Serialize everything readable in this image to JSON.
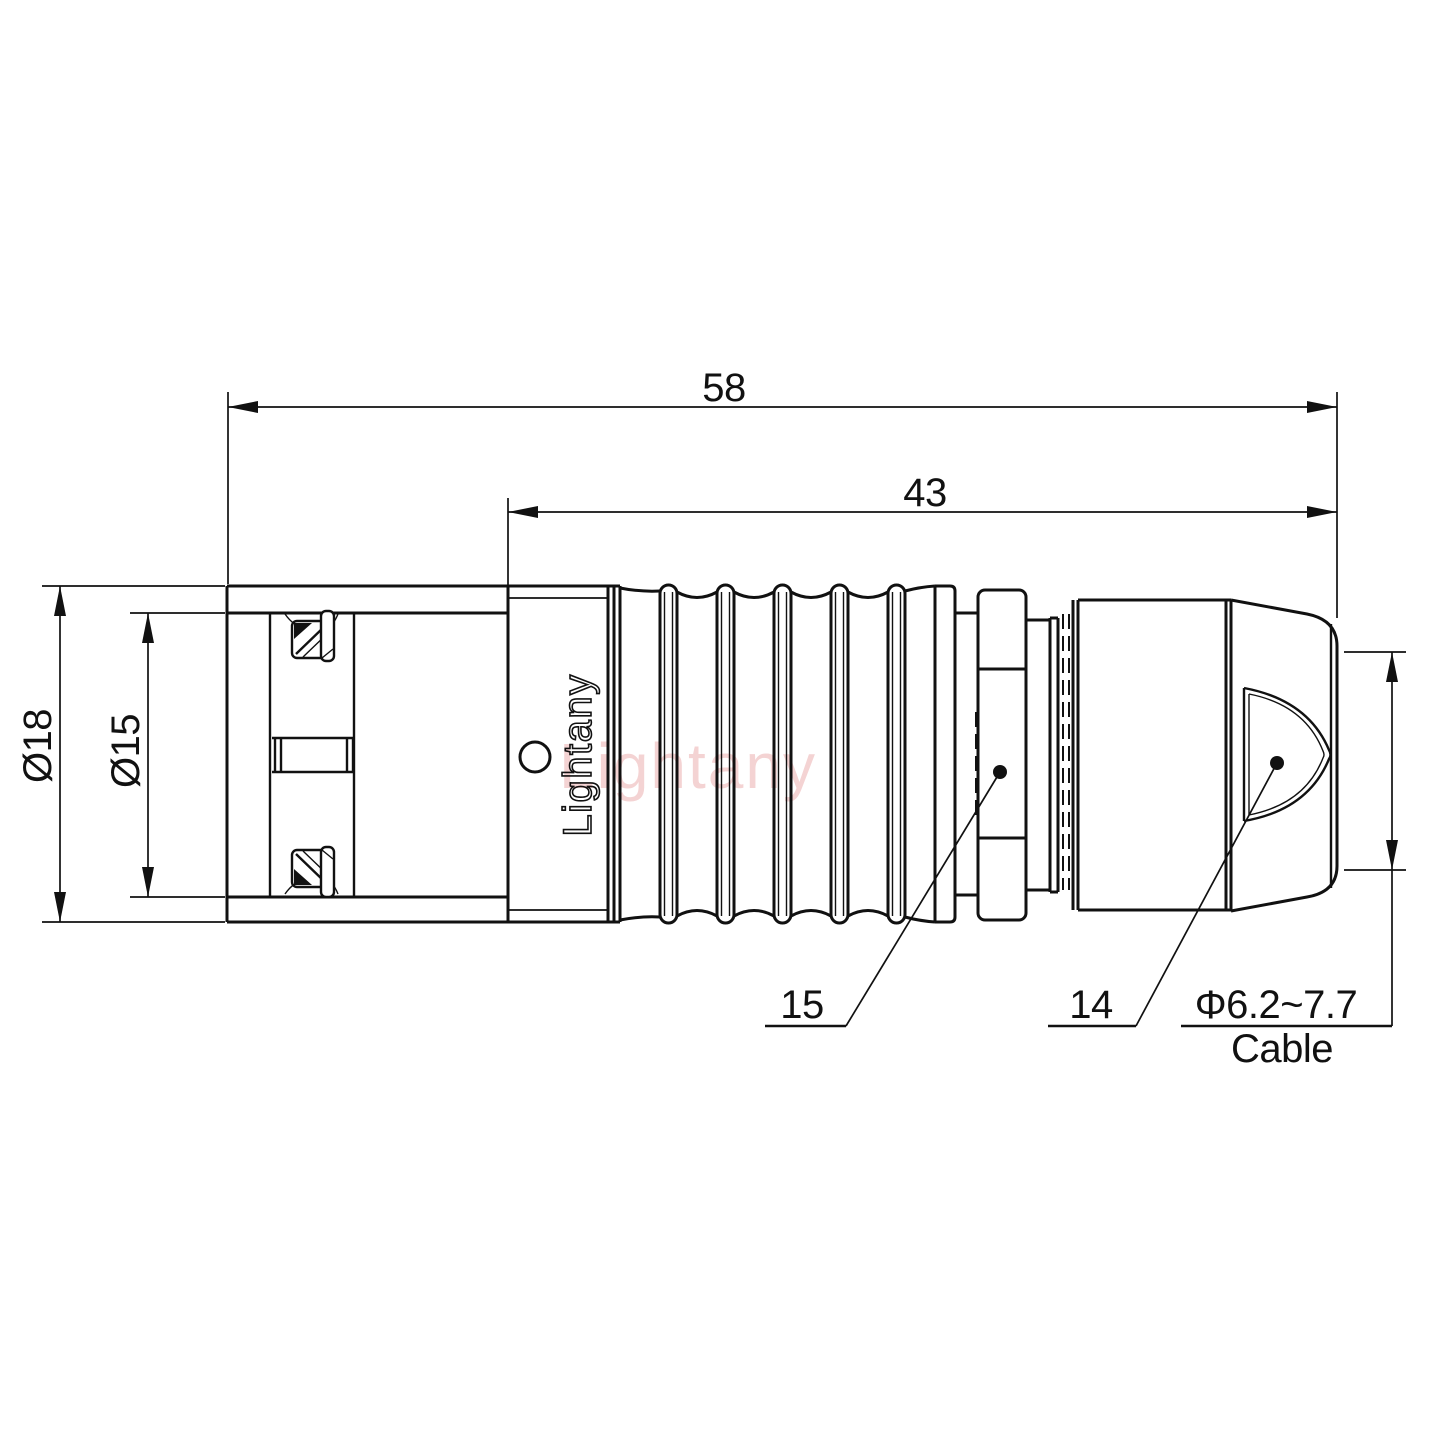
{
  "page": {
    "background": "#ffffff",
    "ink": "#111111",
    "watermark_color": "#f0c4c4"
  },
  "brand": {
    "engraving": "Lightany",
    "watermark": "Lightany"
  },
  "dimensions": {
    "overall_length": "58",
    "body_length": "43",
    "outer_diameter": "Ø18",
    "coupling_diameter": "Ø15",
    "callout_collet": "15",
    "callout_nut": "14",
    "cable_diameter": "Φ6.2~7.7",
    "cable_word": "Cable"
  }
}
